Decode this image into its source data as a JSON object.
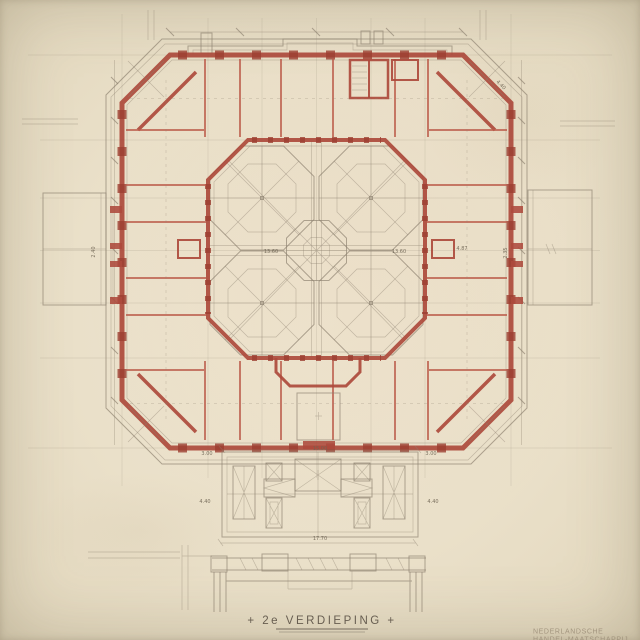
{
  "document": {
    "type_label": "architectural floor plan (scanned drawing)",
    "title": "+ 2e VERDIEPING +",
    "stamp_line1": "NEDERLANDSCHE",
    "stamp_line2": "HANDEL-MAATSCHAPPIJ"
  },
  "colors": {
    "paper": "#eae0c9",
    "wall_red": "#ad4a3c",
    "pier_red": "#9c3f31",
    "partition_red": "#bb5c4b",
    "pencil": "#8d8270",
    "ink": "#5e5448",
    "stamp": "#9a8c76"
  },
  "dims": {
    "portico_width": "15.00",
    "terrace_width": "17.70",
    "court_left": "13.60",
    "court_right": "13.60",
    "room_right": "4.87",
    "wall_right": "2.35",
    "corner_diag": "4.40",
    "left_vert": "2.40",
    "portico_side_left": "4.40",
    "portico_side_right": "4.40",
    "offset_left": "3.00",
    "offset_right": "3.00"
  }
}
